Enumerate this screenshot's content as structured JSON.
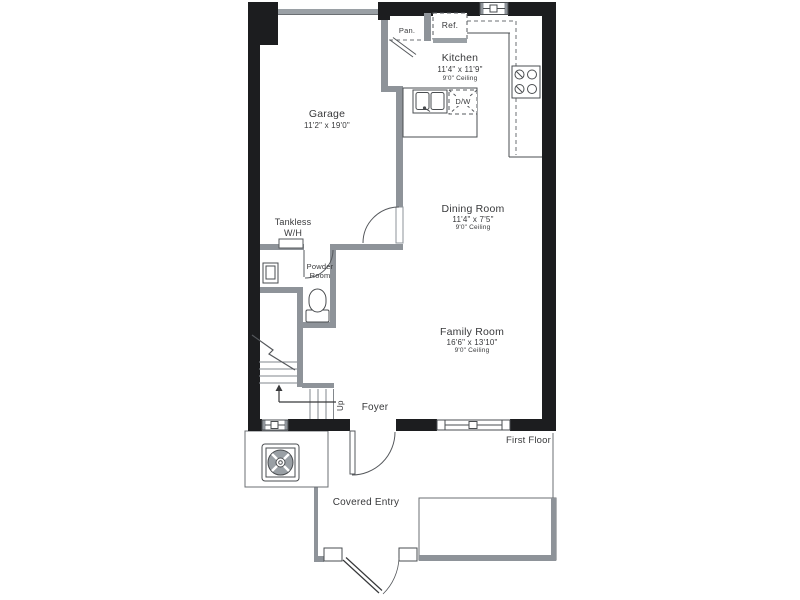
{
  "plan": {
    "title": "First Floor",
    "rooms": {
      "garage": {
        "name": "Garage",
        "dims": "11'2\" x 19'0\""
      },
      "kitchen": {
        "name": "Kitchen",
        "dims": "11'4\" x 11'9\"",
        "ceiling": "9'0\" Ceiling"
      },
      "dining": {
        "name": "Dining Room",
        "dims": "11'4\" x 7'5\"",
        "ceiling": "9'0\" Ceiling"
      },
      "family": {
        "name": "Family Room",
        "dims": "16'6\" x 13'10\"",
        "ceiling": "9'0\" Ceiling"
      },
      "powder": {
        "line1": "Powder",
        "line2": "Room"
      },
      "foyer": {
        "name": "Foyer"
      },
      "covered_entry": {
        "name": "Covered Entry"
      }
    },
    "labels": {
      "tankless_line1": "Tankless",
      "tankless_line2": "W/H",
      "pantry": "Pan.",
      "refrigerator": "Ref.",
      "dishwasher": "D/W",
      "up": "Up",
      "floor": "First Floor"
    },
    "colors": {
      "exterior_wall": "#1c1d1f",
      "interior_wall": "#8e9399",
      "line": "#4a4d50",
      "text": "#38393b",
      "background": "#ffffff"
    }
  }
}
